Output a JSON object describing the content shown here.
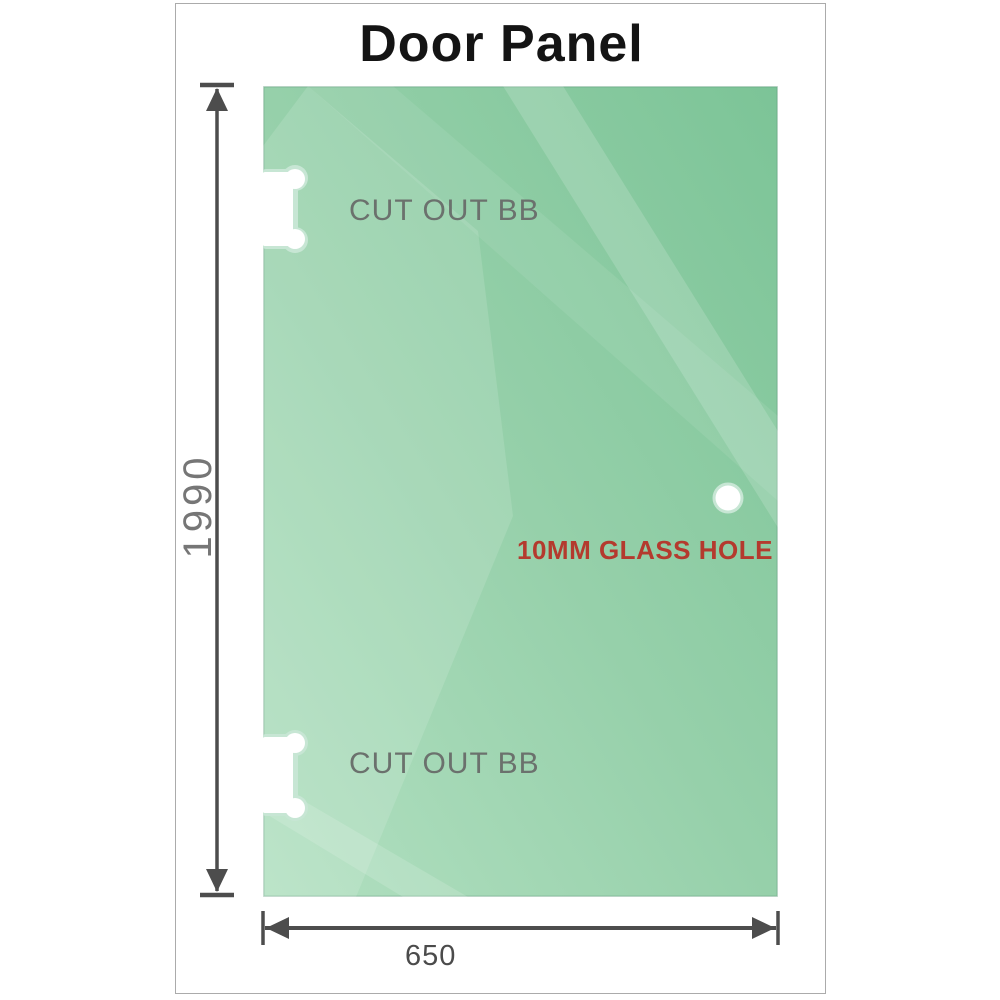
{
  "title": "Door Panel",
  "panel": {
    "cutout_top_label": "CUT OUT BB",
    "cutout_bottom_label": "CUT OUT BB",
    "hole_label": "10MM GLASS HOLE"
  },
  "dimensions": {
    "height_label": "1990",
    "width_label": "650"
  },
  "colors": {
    "glass_dark": "#7cc497",
    "glass_mid": "#96d0aa",
    "glass_light": "#b2e0c1",
    "cutout_rim": "#c7e6d4",
    "hole_label_red": "#b43a2e",
    "label_gray": "#6b716d",
    "dimension_gray": "#4d4d4d",
    "frame_border": "#ababab",
    "title_color": "#141414"
  }
}
